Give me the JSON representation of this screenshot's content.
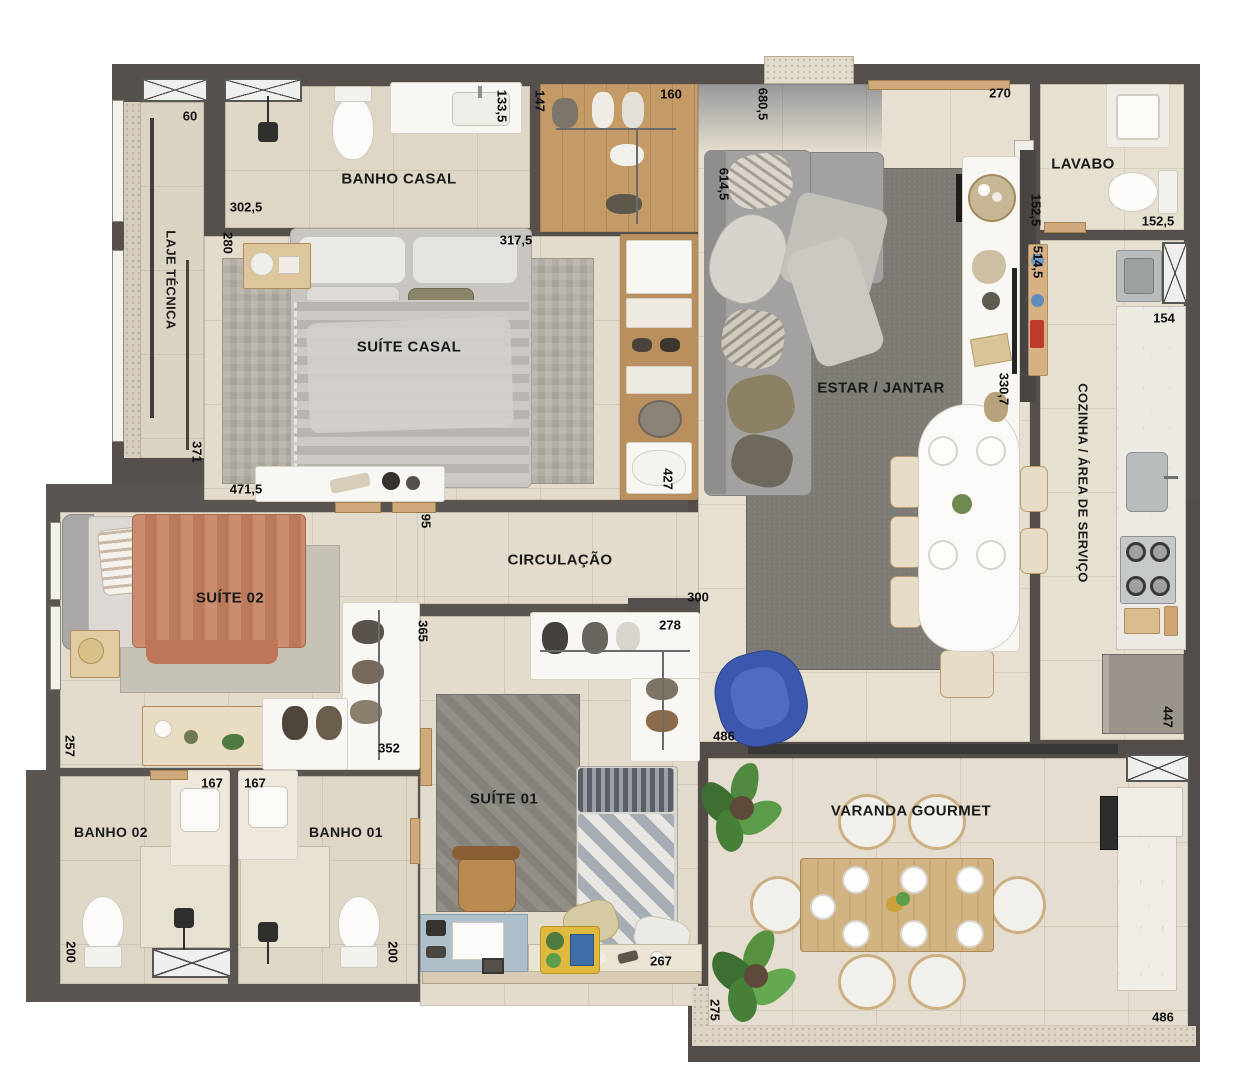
{
  "plan": {
    "rooms": {
      "laje_tecnica": "LAJE TÉCNICA",
      "banho_casal": "BANHO CASAL",
      "suite_casal": "SUÍTE CASAL",
      "circulacao": "CIRCULAÇÃO",
      "suite_02": "SUÍTE 02",
      "banho_02": "BANHO 02",
      "banho_01": "BANHO 01",
      "suite_01": "SUÍTE 01",
      "estar_jantar": "ESTAR / JANTAR",
      "lavabo": "LAVABO",
      "cozinha_area_servico": "COZINHA / ÁREA DE SERVIÇO",
      "varanda_gourmet": "VARANDA GOURMET"
    },
    "dimensions_cm": {
      "d60": "60",
      "d302_5": "302,5",
      "d280": "280",
      "d133_5": "133,5",
      "d147": "147",
      "d160": "160",
      "d680_5": "680,5",
      "d270": "270",
      "d614_5": "614,5",
      "d152_5": "152,5",
      "d514_5": "514,5",
      "d154": "154",
      "d317_5": "317,5",
      "d371": "371",
      "d471_5": "471,5",
      "d427": "427",
      "d95": "95",
      "d300": "300",
      "d365": "365",
      "d278": "278",
      "d330_7": "330,7",
      "d486": "486",
      "d257": "257",
      "d352": "352",
      "d167": "167",
      "d200": "200",
      "d267": "267",
      "d447": "447",
      "d275": "275"
    },
    "colors": {
      "wall": "#56504c",
      "floor": "#e3dccc",
      "accent_blue": "#3b57ae",
      "terracotta": "#c5805f",
      "wood": "#c9a87c",
      "marble": "#edeae4"
    }
  }
}
